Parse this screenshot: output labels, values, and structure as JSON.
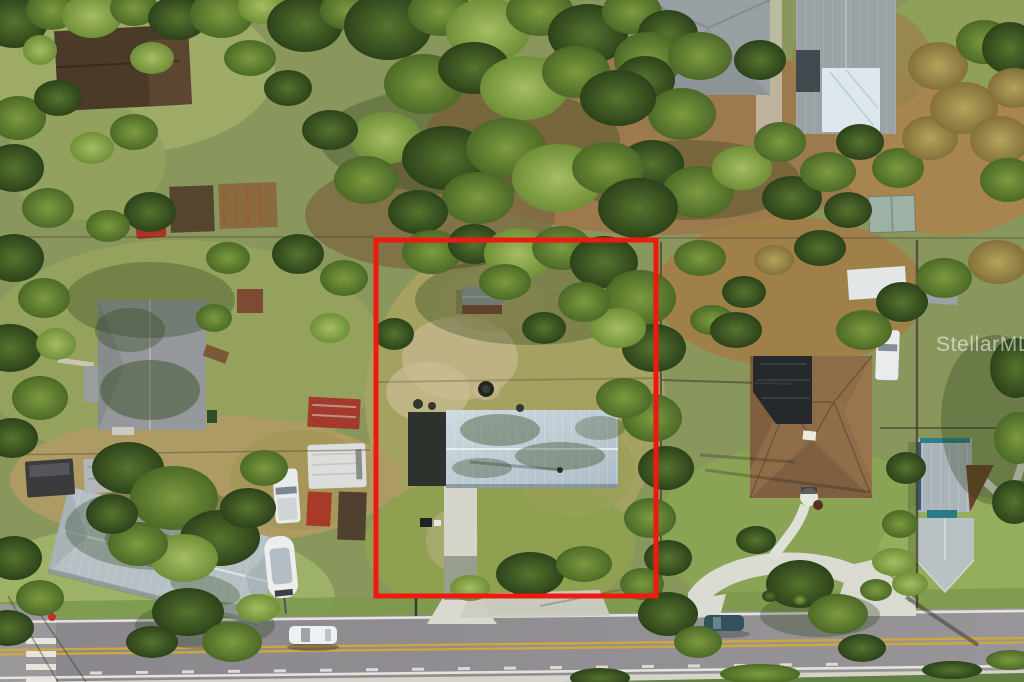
{
  "photo": {
    "kind": "aerial-drone-real-estate-photo",
    "watermark_text": "StellarMLS"
  },
  "boundary_overlay": {
    "label": "subject-property-boundary",
    "color": "#ee1a10",
    "x": 376,
    "y": 240,
    "width": 280,
    "height": 356,
    "stroke_width": 5
  },
  "road": {
    "surface_color": "#8e8b90",
    "center_line_color": "#cfa83b",
    "edge_line_color": "#edebe3",
    "center_line_style": "double-solid-yellow",
    "edge_line_style": "solid-white",
    "extras": [
      "dashed-marker-line",
      "crosswalk-southwest",
      "sidewalk-south",
      "side-street-west"
    ]
  },
  "palette": {
    "grass_base": "#8a975c",
    "dirt_brown": "#9c7a4d",
    "concrete": "#d6d5cb",
    "subject_metal_roof": "#bcc9d2",
    "neighbor_shingle_roof": "#8f6d48",
    "metal_building_roof": "#aab3b8",
    "gray_metal_roof_sw": "#b6c0c4",
    "tree_dark": "#2c431a",
    "tree_light": "#6f8f38",
    "watermark_color": "#ffffff"
  },
  "scene_elements": [
    "subject-property-boundary",
    "subject-house-metal-roof",
    "subject-carport-dark",
    "subject-shed",
    "subject-driveway",
    "fire-pit",
    "grill-and-chair",
    "street",
    "double-yellow-center-line",
    "white-edge-lines",
    "crosswalk",
    "sidewalk",
    "side-street",
    "white-sedan",
    "dark-parked-car",
    "trash-bin",
    "red-mailbox",
    "neighbor-house-northwest",
    "backyard-sheds",
    "red-vehicle",
    "round-bush",
    "neighbor-house-west",
    "picnic-table",
    "red-shed",
    "neighbor-house-southwest",
    "boat-on-trailer",
    "white-pickup-truck",
    "rv-trailer",
    "red-equipment-trailer",
    "utility-trailers",
    "neighbor-house-north",
    "chimney",
    "neighbor-house-northeast",
    "roof-tarp",
    "garden-shed-northeast",
    "neighbor-house-east",
    "solar-panel-array",
    "circular-driveway",
    "entry-walk",
    "metal-outbuilding-east",
    "mulch-bed",
    "white-carport",
    "white-truck",
    "palm-trees",
    "fences",
    "pole-shadows",
    "tree-canopy",
    "watermark"
  ]
}
